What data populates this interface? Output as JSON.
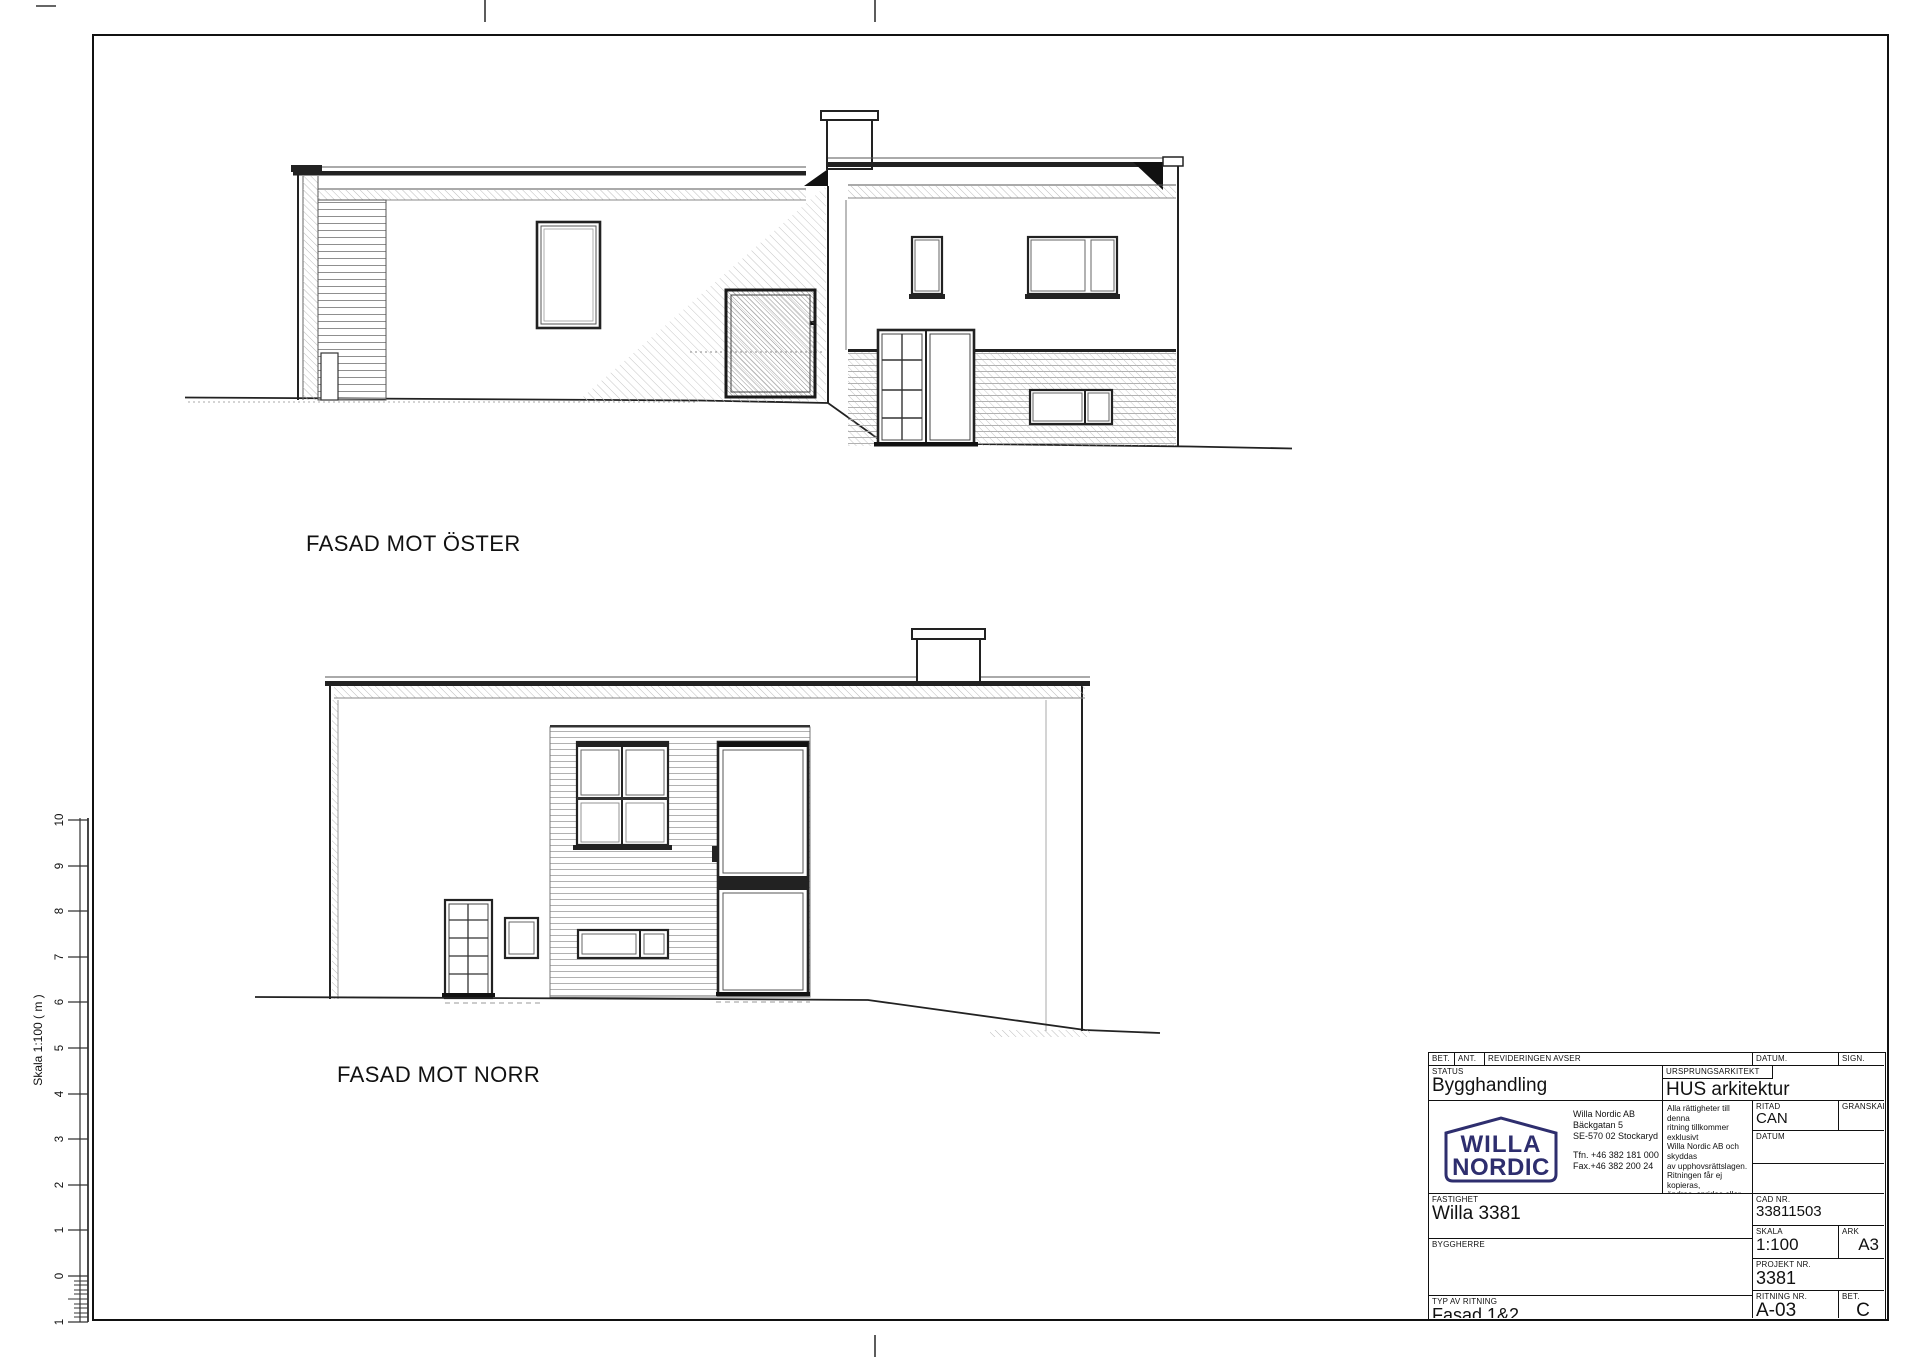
{
  "drawing": {
    "east_label": "FASAD MOT ÖSTER",
    "north_label": "FASAD MOT NORR"
  },
  "scalebar": {
    "label": "Skala 1:100 ( m )",
    "ticks": [
      "10",
      "9",
      "8",
      "7",
      "6",
      "5",
      "4",
      "3",
      "2",
      "1",
      "0"
    ],
    "sub_tick": "1"
  },
  "titleblock": {
    "logo_color": "#2e2e6e",
    "revision_header": {
      "bet": "BET.",
      "ant": "ANT.",
      "avser": "REVIDERINGEN AVSER",
      "datum": "DATUM.",
      "sign": "SIGN."
    },
    "status": {
      "label": "STATUS",
      "value": "Bygghandling"
    },
    "architect": {
      "label": "URSPRUNGSARKITEKT",
      "value": "HUS arkitektur"
    },
    "logo": {
      "line1": "WILLA",
      "line2": "NORDIC"
    },
    "address": [
      "Willa Nordic AB",
      "Bäckgatan 5",
      "SE-570 02  Stockaryd",
      "Tfn. +46 382 181 000",
      "Fax.+46 382 200 24"
    ],
    "copyright": [
      "Alla rättigheter till denna",
      "ritning tillkommer exklusivt",
      "Willa Nordic AB och skyddas",
      "av upphovsrättslagen.",
      "Ritningen får ej kopieras,",
      "ändras, spridas eller på",
      "annat sätt användas utan",
      "Willa Nordic AB:s",
      "skriftliga godkännande."
    ],
    "ritad": {
      "label": "RITAD",
      "value": "CAN"
    },
    "granskad": {
      "label": "GRANSKAD"
    },
    "datum": {
      "label": "DATUM"
    },
    "fastighet": {
      "label": "FASTIGHET",
      "value": "Willa 3381"
    },
    "cad_nr": {
      "label": "CAD NR.",
      "value": "33811503"
    },
    "skala": {
      "label": "SKALA",
      "value": "1:100"
    },
    "ark": {
      "label": "ARK",
      "value": "A3"
    },
    "byggherre": {
      "label": "BYGGHERRE"
    },
    "projekt_nr": {
      "label": "PROJEKT NR.",
      "value": "3381"
    },
    "typ": {
      "label": "TYP AV RITNING",
      "value": "Fasad 1&2"
    },
    "ritning_nr": {
      "label": "RITNING NR.",
      "value": "A-03"
    },
    "bet": {
      "label": "BET.",
      "value": "C"
    }
  }
}
